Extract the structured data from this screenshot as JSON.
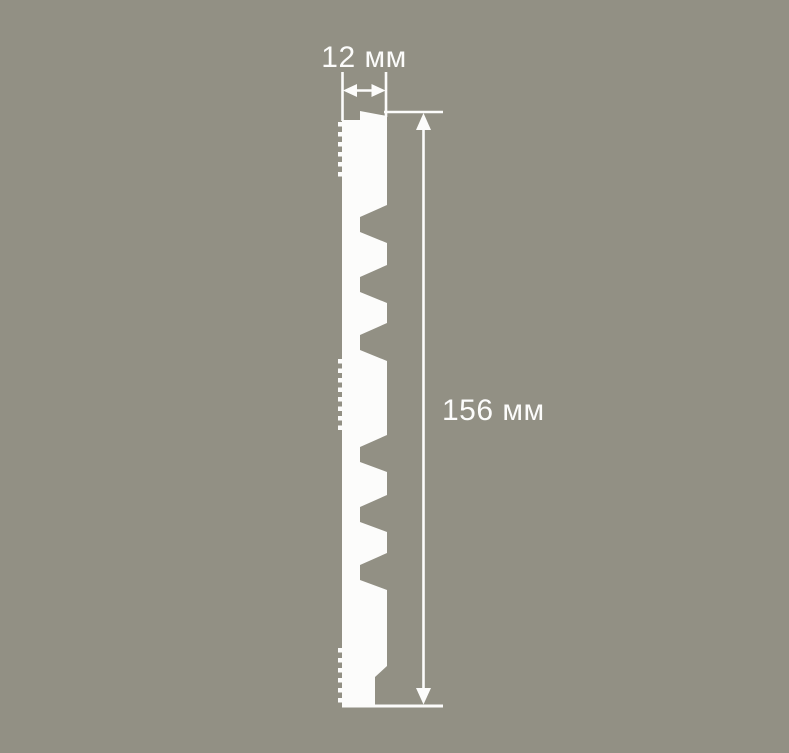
{
  "colors": {
    "background": "#929084",
    "profile": "#FCFCFB",
    "annotation": "#FCFCFB"
  },
  "drawing": {
    "width_dimension": {
      "label": "12 мм",
      "value": 12,
      "unit": "мм"
    },
    "height_dimension": {
      "label": "156 мм",
      "value": 156,
      "unit": "мм"
    }
  }
}
